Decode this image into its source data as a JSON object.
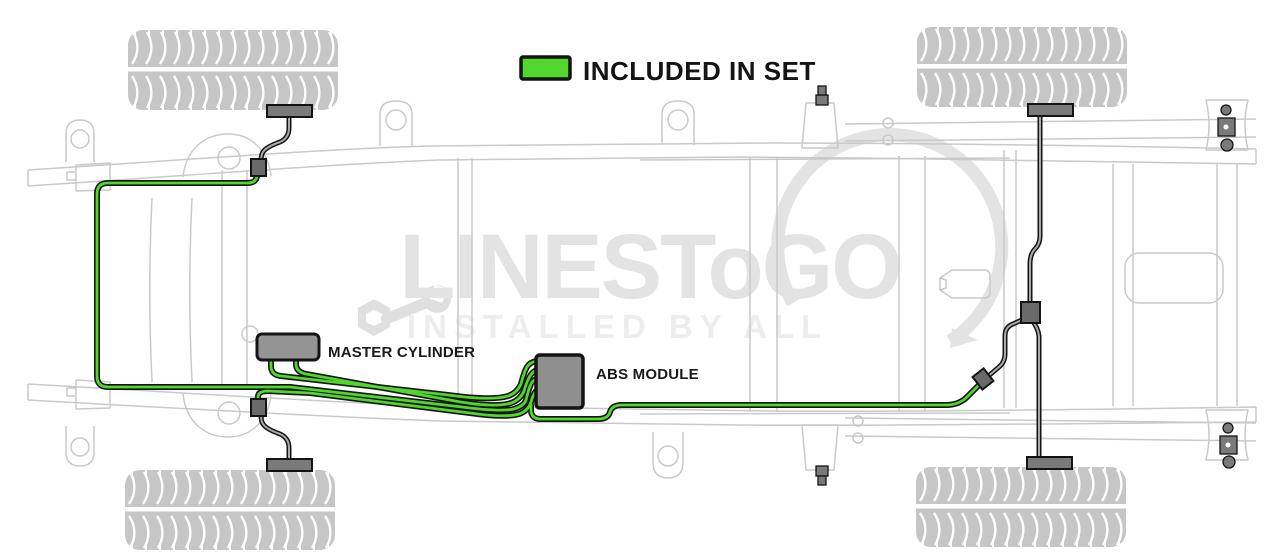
{
  "legend": {
    "label": "INCLUDED IN SET"
  },
  "labels": {
    "master_cylinder": "MASTER CYLINDER",
    "abs_module": "ABS MODULE"
  },
  "watermark": {
    "brand": "LINESToGO",
    "tagline": "INSTALLED BY ALL"
  },
  "colors": {
    "included_green": "#50d62c",
    "line_outline": "#141414",
    "other_line_core": "#a9a9a9",
    "frame": "#c9c9c9",
    "tire": "#c6c6c6",
    "component_gray": "#949494",
    "connector_gray": "#6a6a6a",
    "bracket_gray": "#7a7a7a",
    "watermark_gray": "#e3e3e3",
    "tagline_gray": "#ededed",
    "label_black": "#1a1a1a"
  }
}
